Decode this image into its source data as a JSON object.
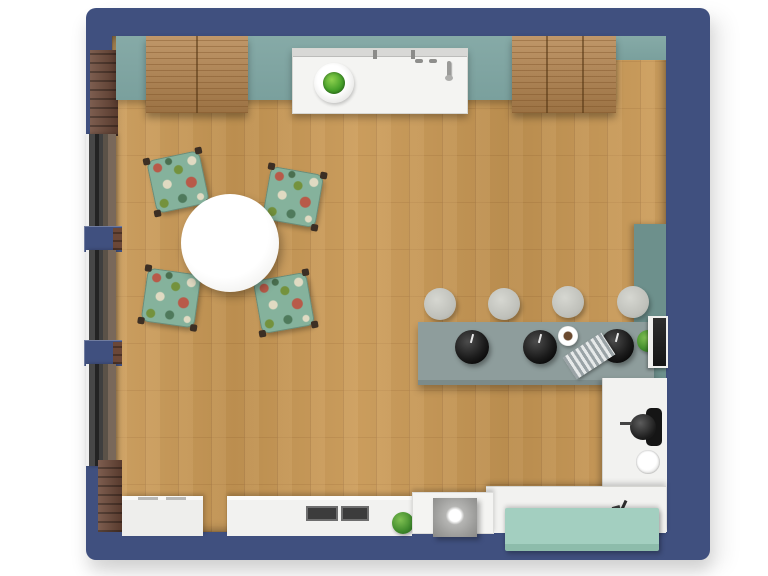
{
  "floorplan": {
    "title": "Kitchen and dining room - 3D floor plan top view",
    "colors": {
      "wall_navy": "#40507f",
      "floor_wood": "#c79754",
      "counter_teal": "#7fa5a2",
      "desk_teal": "#6d908c",
      "bar_gray": "#8e9d9c",
      "cabinet_mint": "#a3cfc0",
      "cabinet_wood": "#b5854f",
      "counter_white": "#f3f3f1",
      "window_frame": "#3a3a3a",
      "brick": "#6b4737",
      "chair_fabric": "#85b29c",
      "pendant_black": "#141414",
      "stool_gray": "#c6c7c1",
      "plant_green": "#3f8a2c"
    },
    "structure": {
      "walls": {
        "label": "Navy exterior walls"
      },
      "floor": {
        "label": "Oak plank floor"
      },
      "windows": {
        "label": "Window",
        "count": 3
      },
      "brick_piers": {
        "label": "Brick wall pier",
        "count": 2
      }
    },
    "furniture": {
      "upper_cabinet_left": {
        "label": "Wooden cabinet block (left)"
      },
      "upper_cabinet_right": {
        "label": "Wooden cabinet block (right)"
      },
      "teal_countertop": {
        "label": "Teal countertop run"
      },
      "kitchen_counter_top": {
        "label": "White counter with herb bowl and faucet"
      },
      "herb_bowl": {
        "label": "Bowl with green herbs"
      },
      "dining_table": {
        "label": "Round white dining table"
      },
      "dining_chair": {
        "label": "Floral upholstered chair",
        "count": 4
      },
      "bar_counter": {
        "label": "Gray bar counter"
      },
      "bar_stool": {
        "label": "Round gray bar stool",
        "count": 4
      },
      "pendant_light": {
        "label": "Black pendant lamp",
        "count": 3
      },
      "coffee_cup": {
        "label": "Coffee cup"
      },
      "placemat": {
        "label": "Striped placemat"
      },
      "desk": {
        "label": "Teal desk along right wall"
      },
      "laptop": {
        "label": "Open laptop"
      },
      "plant_on_counter": {
        "label": "Small potted plant"
      },
      "coffee_machine": {
        "label": "Black coffee machine"
      },
      "round_sink": {
        "label": "Round sink"
      },
      "right_counter": {
        "label": "White L-shaped counter"
      },
      "mint_sideboard": {
        "label": "Mint green sideboard"
      },
      "cooktop": {
        "label": "Two-zone dark cooktop",
        "zones": 2
      },
      "island_appliance": {
        "label": "Island with gray appliance cube"
      },
      "bottom_plant": {
        "label": "Green plant"
      },
      "white_cabinet": {
        "label": "White cabinet (bottom left)"
      }
    }
  }
}
